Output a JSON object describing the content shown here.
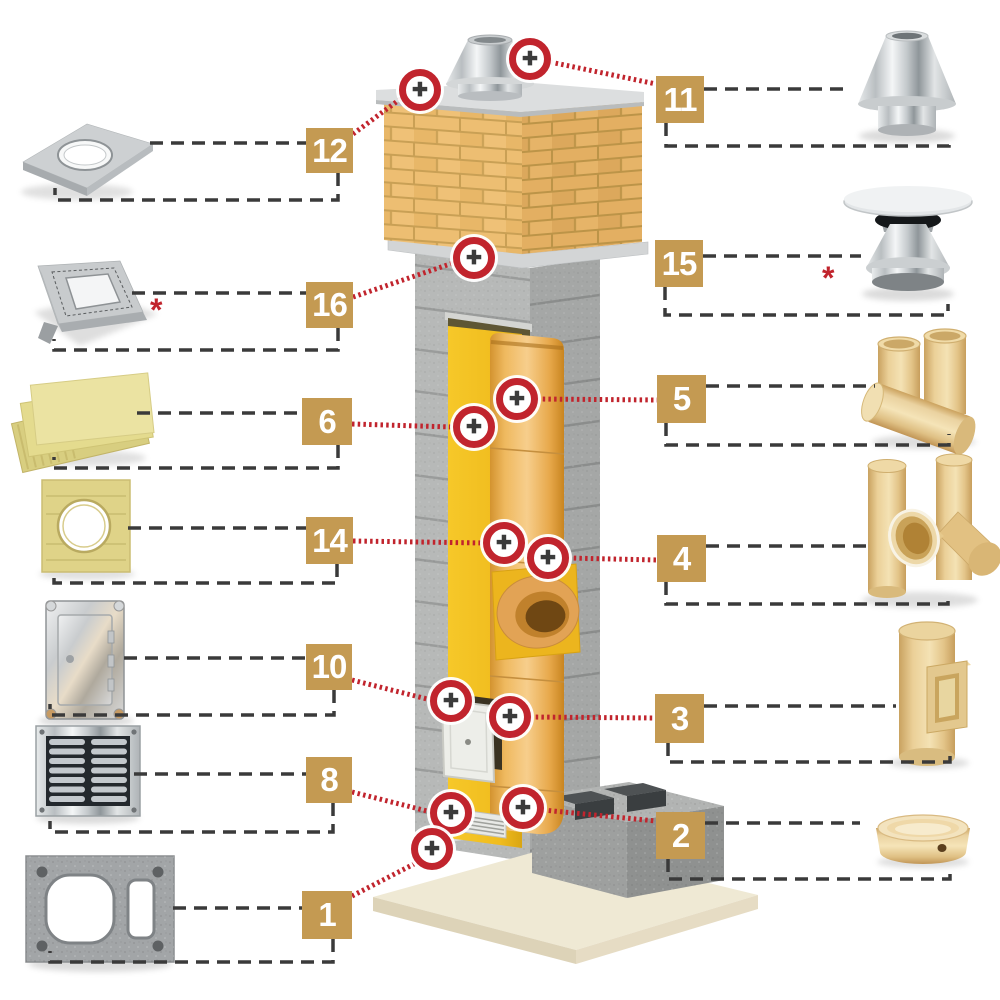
{
  "colors": {
    "accent_gold": "#C49A52",
    "marker_red": "#C1242D",
    "connector_dark": "#3A3A3A",
    "brick": "#EDBE72",
    "insulation_yellow": "#F2BF25",
    "liner_orange": "#E8A94C",
    "concrete_grey": "#B7B9B8",
    "foundation_beige": "#EFE9D4"
  },
  "icons": {
    "plus": "✚"
  },
  "annotations": {
    "asterisk": "*"
  },
  "labels": [
    {
      "number": "12"
    },
    {
      "number": "11"
    },
    {
      "number": "16"
    },
    {
      "number": "15"
    },
    {
      "number": "6"
    },
    {
      "number": "5"
    },
    {
      "number": "14"
    },
    {
      "number": "4"
    },
    {
      "number": "10"
    },
    {
      "number": "3"
    },
    {
      "number": "8"
    },
    {
      "number": "2"
    },
    {
      "number": "1"
    }
  ]
}
